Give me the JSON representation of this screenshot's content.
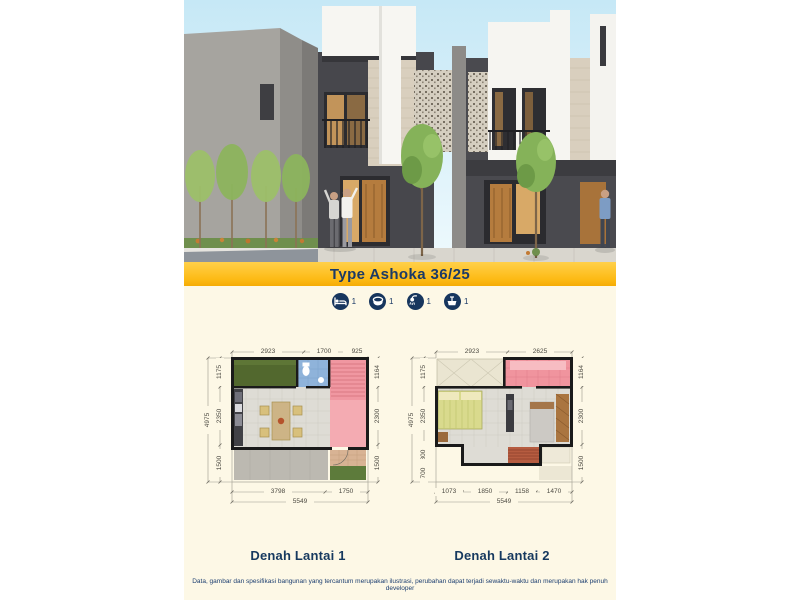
{
  "banner": {
    "title": "Type Ashoka 36/25"
  },
  "features": [
    {
      "icon": "bed-icon",
      "count": "1"
    },
    {
      "icon": "bathtub-icon",
      "count": "1"
    },
    {
      "icon": "shower-icon",
      "count": "1"
    },
    {
      "icon": "sink-icon",
      "count": "1"
    }
  ],
  "plans": [
    {
      "label": "Denah Lantai 1",
      "dims": {
        "top": [
          "2923",
          "1700",
          "925"
        ],
        "left_total": "4975",
        "left": [
          "1175",
          "2350",
          "1500"
        ],
        "right": [
          "1164",
          "2300",
          "1500"
        ],
        "bottom": [
          "3798",
          "1750"
        ],
        "bottom_total": "5549"
      }
    },
    {
      "label": "Denah Lantai 2",
      "dims": {
        "top": [
          "2923",
          "2625"
        ],
        "left_total": "4975",
        "left": [
          "1175",
          "2350",
          "800",
          "700"
        ],
        "right": [
          "1164",
          "2300",
          "1500"
        ],
        "bottom": [
          "1073",
          "1850",
          "1158",
          "1470"
        ],
        "bottom_total": "5549"
      }
    }
  ],
  "disclaimer": "Data, gambar dan spesifikasi bangunan yang tercantum merupakan ilustrasi, perubahan dapat terjadi sewaktu-waktu dan merupakan hak penuh developer",
  "colors": {
    "navy": "#1b3a66",
    "gold": "#fdbb16",
    "cream": "#fdf8e6"
  }
}
